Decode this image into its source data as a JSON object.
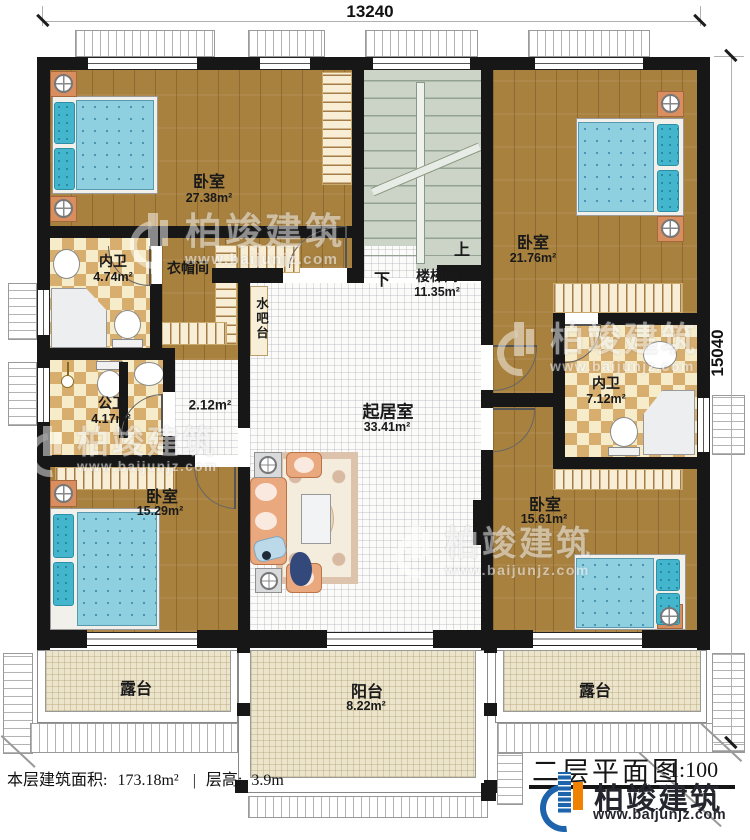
{
  "dimensions": {
    "width_top": "13240",
    "height_right": "15040"
  },
  "rooms": {
    "bedroom_tl": {
      "name": "卧室",
      "area": "27.38m²"
    },
    "ensuite_tl": {
      "name": "内卫",
      "area": "4.74m²"
    },
    "cloakroom": {
      "name": "衣帽间"
    },
    "water_bar": {
      "name": "水吧台"
    },
    "stairwell": {
      "name": "楼梯间",
      "area": "11.35m²",
      "up": "上",
      "down": "下"
    },
    "bedroom_tr": {
      "name": "卧室",
      "area": "21.76m²"
    },
    "ensuite_r": {
      "name": "内卫",
      "area": "7.12m²"
    },
    "public_bath": {
      "name": "公卫",
      "area": "4.17m²"
    },
    "hallway": {
      "area": "2.12m²"
    },
    "living": {
      "name": "起居室",
      "area": "33.41m²"
    },
    "bedroom_bl": {
      "name": "卧室",
      "area": "15.29m²"
    },
    "bedroom_br": {
      "name": "卧室",
      "area": "15.61m²"
    },
    "terrace_left": {
      "name": "露台"
    },
    "balcony": {
      "name": "阳台",
      "area": "8.22m²"
    },
    "terrace_right": {
      "name": "露台"
    }
  },
  "footer": {
    "stats_prefix": "本层建筑面积:",
    "stats_area": "173.18m²",
    "divider": "|",
    "stats_height_label": "层高:",
    "stats_height": "3.9m"
  },
  "title_block": {
    "title": "二层平面图",
    "scale": "1:100",
    "brand": "柏竣建筑",
    "website": "www.baijunjz.com"
  },
  "watermark": {
    "brand": "柏竣建筑",
    "website": "www.baijunjz.com"
  },
  "colors": {
    "wall": "#171717",
    "wood": "#a8813f",
    "tile": "#d8ae6e",
    "stair": "#ccd3c7",
    "terrace": "#ece5cc",
    "brand_blue": "#1d64ad",
    "brand_orange": "#ef8200",
    "bed_blue": "#8ecfe0"
  }
}
